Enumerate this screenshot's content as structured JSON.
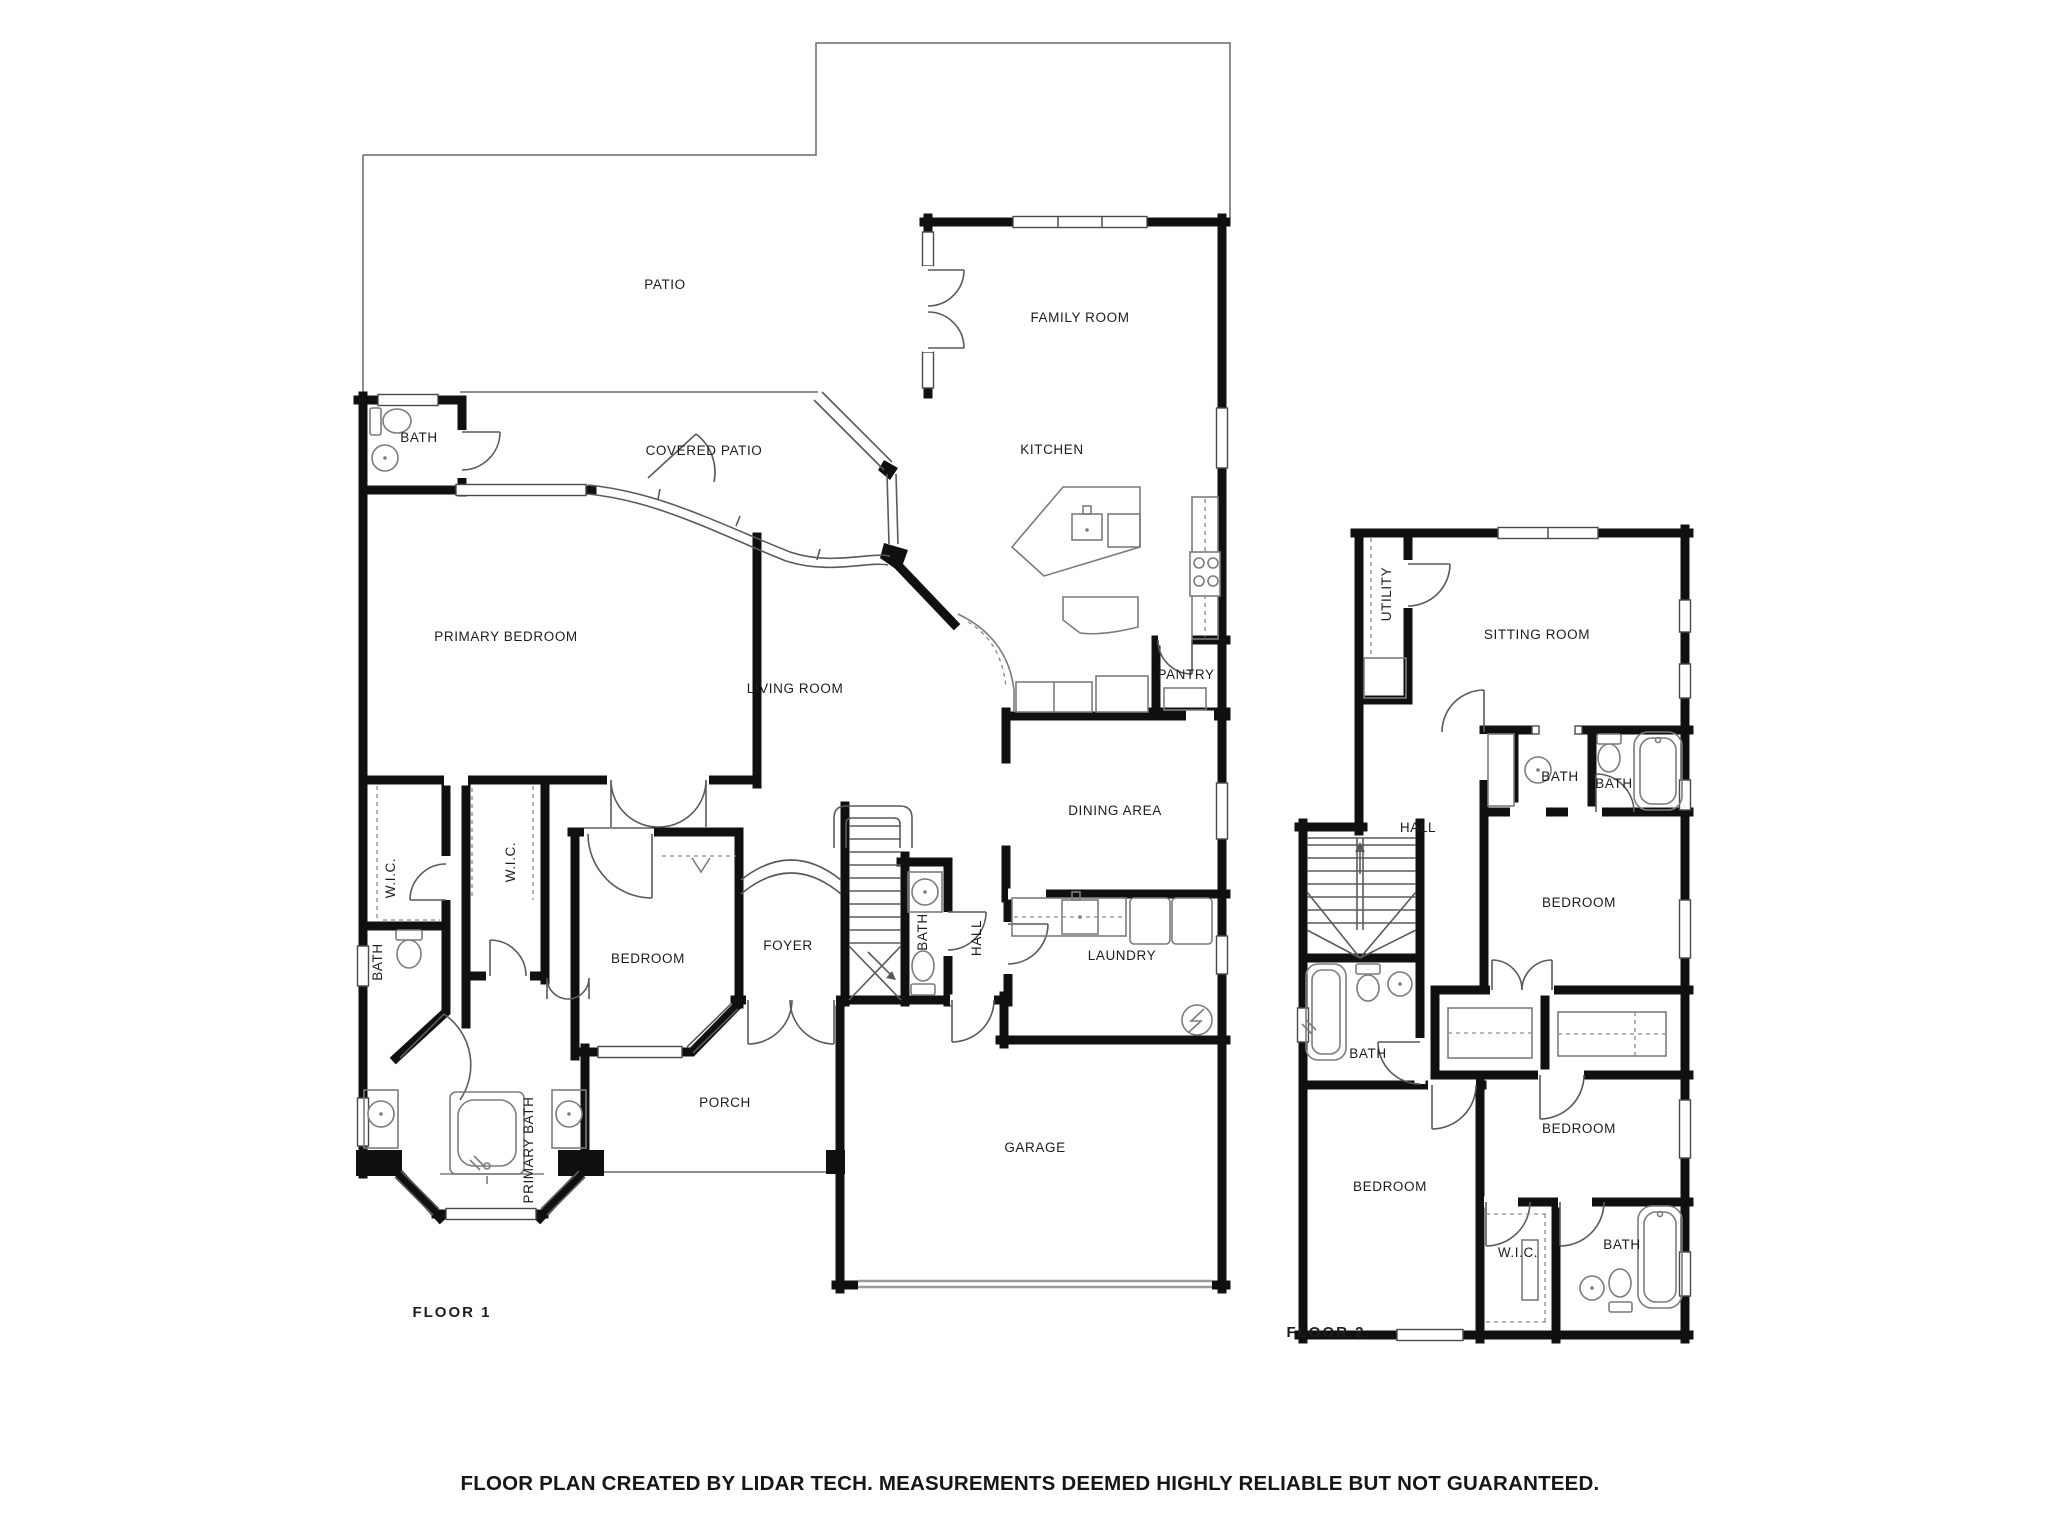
{
  "caption": "FLOOR PLAN CREATED BY LIDAR TECH. MEASUREMENTS DEEMED HIGHLY RELIABLE BUT NOT GUARANTEED.",
  "colors": {
    "wall": "#101010",
    "thin_line": "#5a5a5a",
    "fixture_line": "#7c7c7c",
    "garage_door": "#9b9b9b",
    "text": "#1d1d1d",
    "background": "#ffffff"
  },
  "icons": {
    "electrical-panel-icon": "circle with lightning bolt",
    "stairs-icon": "treads with direction arrow",
    "toilet-icon": "tank and bowl outline",
    "sink-icon": "circle basin with tap dot",
    "bathtub-icon": "rounded tub outline",
    "stove-icon": "four burner circles",
    "washer-icon": "square appliance",
    "dryer-icon": "square appliance"
  },
  "floor1": {
    "title": "FLOOR 1",
    "rooms": [
      {
        "label": "PATIO"
      },
      {
        "label": "FAMILY ROOM"
      },
      {
        "label": "BATH"
      },
      {
        "label": "COVERED PATIO"
      },
      {
        "label": "KITCHEN"
      },
      {
        "label": "PRIMARY BEDROOM"
      },
      {
        "label": "LIVING ROOM"
      },
      {
        "label": "PANTRY"
      },
      {
        "label": "W.I.C."
      },
      {
        "label": "W.I.C."
      },
      {
        "label": "DINING AREA"
      },
      {
        "label": "BEDROOM"
      },
      {
        "label": "FOYER"
      },
      {
        "label": "BATH"
      },
      {
        "label": "HALL"
      },
      {
        "label": "LAUNDRY"
      },
      {
        "label": "BATH"
      },
      {
        "label": "PORCH"
      },
      {
        "label": "PRIMARY BATH"
      },
      {
        "label": "GARAGE"
      }
    ]
  },
  "floor2": {
    "title": "FLOOR 2",
    "rooms": [
      {
        "label": "UTILITY"
      },
      {
        "label": "SITTING ROOM"
      },
      {
        "label": "BATH"
      },
      {
        "label": "BATH"
      },
      {
        "label": "HALL"
      },
      {
        "label": "BEDROOM"
      },
      {
        "label": "BATH"
      },
      {
        "label": "BEDROOM"
      },
      {
        "label": "BEDROOM"
      },
      {
        "label": "W.I.C."
      },
      {
        "label": "BATH"
      }
    ]
  }
}
